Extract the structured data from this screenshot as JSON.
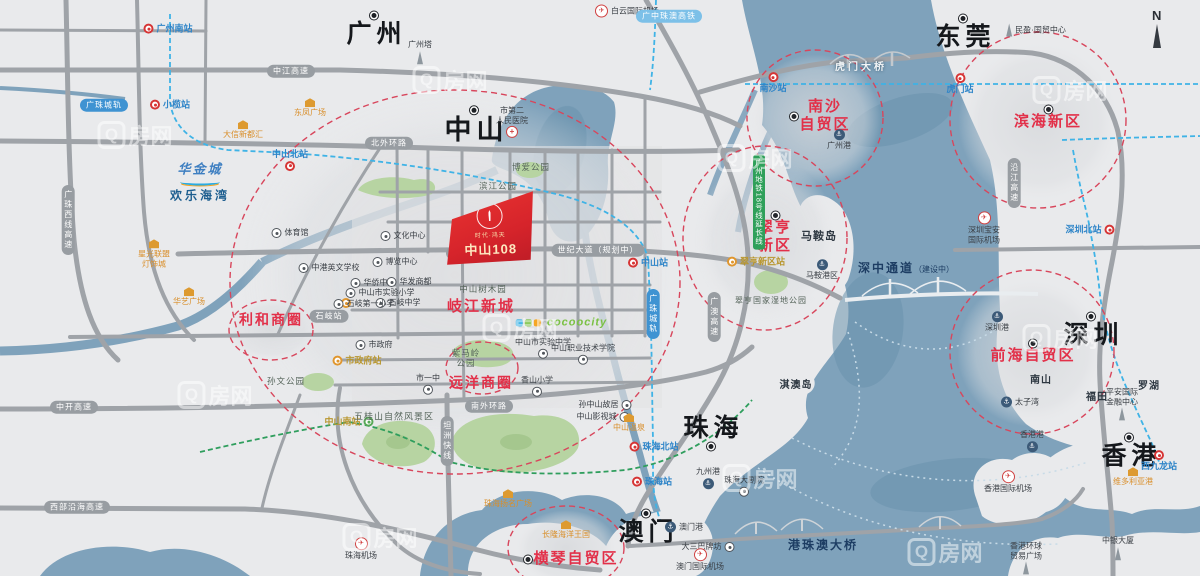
{
  "colors": {
    "water": "#7fa2bb",
    "land": "#e9eaec",
    "road": "#9fa3a8",
    "accent_red": "#e23049",
    "rail_blue": "#3fb3e6",
    "park_green": "#b7d4a2",
    "zone_red": "#d8465c"
  },
  "compass": {
    "label": "N"
  },
  "watermark": {
    "q": "Q",
    "text": "房网",
    "positions": [
      [
        135,
        135
      ],
      [
        450,
        80
      ],
      [
        755,
        158
      ],
      [
        1070,
        90
      ],
      [
        215,
        395
      ],
      [
        520,
        328
      ],
      [
        1060,
        338
      ],
      [
        760,
        478
      ],
      [
        380,
        537
      ],
      [
        945,
        552
      ]
    ]
  },
  "project": {
    "badge_line1": "时代·鸿天",
    "name": "中山108"
  },
  "logo": {
    "line1": "华金城",
    "line2": "欢乐海湾"
  },
  "labels": [
    {
      "n": "city-guangzhou",
      "c": "city",
      "t": "广州",
      "x": 374,
      "y": 31
    },
    {
      "n": "city-dongguan",
      "c": "city",
      "t": "东莞",
      "x": 963,
      "y": 34
    },
    {
      "n": "city-zhongshan",
      "c": "city",
      "t": "中山",
      "x": 474,
      "y": 127,
      "big": 1
    },
    {
      "n": "city-shenzhen",
      "c": "city",
      "t": "深圳",
      "x": 1091,
      "y": 332
    },
    {
      "n": "city-zhuhai",
      "c": "city",
      "t": "珠海",
      "x": 711,
      "y": 431,
      "dot": "b"
    },
    {
      "n": "city-macau",
      "c": "city",
      "t": "澳门",
      "x": 646,
      "y": 529
    },
    {
      "n": "city-hongkong",
      "c": "city",
      "t": "香港",
      "x": 1129,
      "y": 453
    },
    {
      "n": "zone-nansha",
      "c": "zone",
      "t": "南沙\n自贸区",
      "x": 821,
      "y": 116,
      "dot": "l"
    },
    {
      "n": "zone-binhai",
      "c": "zone",
      "t": "滨海新区",
      "x": 1048,
      "y": 119,
      "dot": "t"
    },
    {
      "n": "zone-cuiheng",
      "c": "zone",
      "t": "翠亨\n新区",
      "x": 775,
      "y": 234,
      "dot": "t"
    },
    {
      "n": "zone-qianhai",
      "c": "zone",
      "t": "前海自贸区",
      "x": 1033,
      "y": 353,
      "dot": "t"
    },
    {
      "n": "zone-lihe",
      "c": "zone",
      "t": "利和商圈",
      "x": 271,
      "y": 320,
      "sz": 14
    },
    {
      "n": "zone-yuanyang",
      "c": "zone",
      "t": "远洋商圈",
      "x": 481,
      "y": 383,
      "sz": 14
    },
    {
      "n": "zone-qijiang",
      "c": "zone",
      "t": "岐江新城",
      "x": 481,
      "y": 307
    },
    {
      "n": "zone-hengqin",
      "c": "zone",
      "t": "横琴自贸区",
      "x": 572,
      "y": 559,
      "dot": "l"
    },
    {
      "n": "station-guangzhounan",
      "c": "stm",
      "t": "广州南站",
      "x": 168,
      "y": 29,
      "s": "r"
    },
    {
      "n": "station-xiaolan",
      "c": "stm",
      "t": "小榄站",
      "x": 170,
      "y": 105,
      "s": "r"
    },
    {
      "n": "station-zhongshanbei",
      "c": "stm",
      "t": "中山北站",
      "x": 290,
      "y": 160,
      "s": "t"
    },
    {
      "n": "station-zhongshan",
      "c": "stm",
      "t": "中山站",
      "x": 648,
      "y": 263,
      "s": "r"
    },
    {
      "n": "station-nansha",
      "c": "stm",
      "t": "南沙站",
      "x": 773,
      "y": 83,
      "s": "b"
    },
    {
      "n": "station-humen",
      "c": "stm",
      "t": "虎门站",
      "x": 960,
      "y": 84,
      "s": "b"
    },
    {
      "n": "station-shenzhenbei",
      "c": "stm",
      "t": "深圳北站",
      "x": 1090,
      "y": 230,
      "s": "l"
    },
    {
      "n": "station-zhuhaibei",
      "c": "stm",
      "t": "珠海北站",
      "x": 654,
      "y": 447,
      "s": "r"
    },
    {
      "n": "station-zhuhai",
      "c": "stm",
      "t": "珠海站",
      "x": 652,
      "y": 482,
      "s": "r"
    },
    {
      "n": "station-xijiulong",
      "c": "stm",
      "t": "西九龙站",
      "x": 1159,
      "y": 461,
      "s": "b"
    },
    {
      "n": "station-zhongshannan",
      "c": "stg",
      "t": "中山南站",
      "x": 349,
      "y": 422,
      "s": "l"
    },
    {
      "n": "station-shizhengfu",
      "c": "sto",
      "t": "市政府站",
      "x": 357,
      "y": 361,
      "s": "r"
    },
    {
      "n": "station-cuihengxinqu",
      "c": "sto",
      "t": "翠亨新区站",
      "x": 756,
      "y": 262,
      "s": "r"
    },
    {
      "n": "station-minor-1",
      "c": "sto",
      "t": "",
      "x": 346,
      "y": 303,
      "s": "r"
    },
    {
      "n": "station-minor-2",
      "c": "sto",
      "t": "",
      "x": 512,
      "y": 243,
      "s": "r"
    },
    {
      "n": "landmark-no2-hospital",
      "c": "lm",
      "t": "市第二\n人民医院",
      "x": 512,
      "y": 122,
      "i": "hosp",
      "s": "t"
    },
    {
      "n": "landmark-wenhua-center",
      "c": "lm",
      "t": "文化中心",
      "x": 403,
      "y": 236
    },
    {
      "n": "landmark-tiyuguan",
      "c": "lm",
      "t": "体育馆",
      "x": 290,
      "y": 233
    },
    {
      "n": "landmark-bolan-center",
      "c": "lm",
      "t": "博览中心",
      "x": 395,
      "y": 262
    },
    {
      "n": "landmark-zhonggang-school",
      "c": "lm",
      "t": "中港英文学校",
      "x": 329,
      "y": 268
    },
    {
      "n": "landmark-huaqiao-school",
      "c": "lm",
      "t": "华侨中学",
      "x": 373,
      "y": 283
    },
    {
      "n": "landmark-shiyan-primary",
      "c": "lm",
      "t": "中山市实验小学",
      "x": 380,
      "y": 293
    },
    {
      "n": "landmark-huafa-mall",
      "c": "lm",
      "t": "华发商都",
      "x": 409,
      "y": 282
    },
    {
      "n": "landmark-shiqi-school",
      "c": "lm",
      "t": "石岐中学",
      "x": 398,
      "y": 303
    },
    {
      "n": "landmark-shiqi-primary",
      "c": "lm",
      "t": "石岐第一小学",
      "x": 364,
      "y": 304
    },
    {
      "n": "landmark-city-hall",
      "c": "lm",
      "t": "市政府",
      "x": 374,
      "y": 345
    },
    {
      "n": "landmark-shiyizhong",
      "c": "lm",
      "t": "市一中",
      "x": 428,
      "y": 384,
      "s": "t"
    },
    {
      "n": "landmark-shiyan-middle",
      "c": "lm",
      "t": "中山市实验中学",
      "x": 543,
      "y": 348,
      "s": "t"
    },
    {
      "n": "landmark-polytechnic",
      "c": "lm",
      "t": "中山职业技术学院",
      "x": 583,
      "y": 354,
      "s": "t"
    },
    {
      "n": "landmark-xiangshan-primary",
      "c": "lm",
      "t": "香山小学",
      "x": 537,
      "y": 386,
      "s": "t"
    },
    {
      "n": "landmark-sun-yatsen-residence",
      "c": "lm",
      "t": "孙中山故居",
      "x": 605,
      "y": 405,
      "s": "l"
    },
    {
      "n": "landmark-film-city",
      "c": "lm",
      "t": "中山影视城",
      "x": 603,
      "y": 417,
      "s": "l"
    },
    {
      "n": "landmark-zhuhai-opera",
      "c": "lm",
      "t": "珠海大剧院",
      "x": 744,
      "y": 486,
      "s": "t"
    },
    {
      "n": "landmark-dasanba",
      "c": "lm",
      "t": "大三巴牌坊",
      "x": 708,
      "y": 547,
      "s": "l"
    },
    {
      "n": "landmark-minying-itc",
      "c": "lm",
      "t": "民盈·国贸中心",
      "x": 1036,
      "y": 30,
      "i": "tower"
    },
    {
      "n": "landmark-pingan-ifc",
      "c": "lm",
      "t": "平安国际\n金融中心",
      "x": 1122,
      "y": 404,
      "i": "tower",
      "s": "t"
    },
    {
      "n": "landmark-boc-tower",
      "c": "lm",
      "t": "中银大厦",
      "x": 1118,
      "y": 548,
      "i": "tower",
      "s": "t"
    },
    {
      "n": "landmark-icc",
      "c": "lm",
      "t": "香港环球\n贸易广场",
      "x": 1026,
      "y": 558,
      "i": "tower",
      "s": "t"
    },
    {
      "n": "landmark-canton-tower",
      "c": "lm",
      "t": "广州塔",
      "x": 420,
      "y": 52,
      "i": "tower",
      "s": "t"
    },
    {
      "n": "area-maan-island",
      "c": "area",
      "t": "马鞍岛",
      "x": 819,
      "y": 237,
      "sz": 11
    },
    {
      "n": "area-qiao-island",
      "c": "area",
      "t": "淇澳岛",
      "x": 796,
      "y": 386
    },
    {
      "n": "area-nanshan",
      "c": "area",
      "t": "南山",
      "x": 1041,
      "y": 381
    },
    {
      "n": "area-futian",
      "c": "area",
      "t": "福田",
      "x": 1097,
      "y": 398
    },
    {
      "n": "area-luohu",
      "c": "area",
      "t": "罗湖",
      "x": 1149,
      "y": 387
    },
    {
      "n": "port-guangzhou",
      "c": "port",
      "t": "广州港",
      "x": 839,
      "y": 140,
      "s": "b"
    },
    {
      "n": "port-maan",
      "c": "port",
      "t": "马鞍港区",
      "x": 822,
      "y": 270,
      "s": "b"
    },
    {
      "n": "port-shenzhen",
      "c": "port",
      "t": "深圳港",
      "x": 997,
      "y": 322,
      "s": "b"
    },
    {
      "n": "port-taiziwan",
      "c": "port",
      "t": "太子湾",
      "x": 1020,
      "y": 402,
      "s": "r"
    },
    {
      "n": "port-hongkong",
      "c": "port",
      "t": "香港港",
      "x": 1032,
      "y": 441,
      "s": "t"
    },
    {
      "n": "port-jiuzhou",
      "c": "port",
      "t": "九州港",
      "x": 708,
      "y": 478,
      "s": "t"
    },
    {
      "n": "port-macau",
      "c": "port",
      "t": "澳门港",
      "x": 684,
      "y": 527,
      "s": "r"
    },
    {
      "n": "airport-baiyun",
      "c": "air",
      "t": "白云国际机场",
      "x": 627,
      "y": 11,
      "s": "r"
    },
    {
      "n": "airport-baoan",
      "c": "air",
      "t": "深圳宝安\n国际机场",
      "x": 984,
      "y": 228,
      "s": "b"
    },
    {
      "n": "airport-zhuhai",
      "c": "air",
      "t": "珠海机场",
      "x": 361,
      "y": 549,
      "s": "b"
    },
    {
      "n": "airport-macau",
      "c": "air",
      "t": "澳门国际机场",
      "x": 700,
      "y": 560,
      "s": "b"
    },
    {
      "n": "airport-hongkong",
      "c": "air",
      "t": "香港国际机场",
      "x": 1008,
      "y": 482,
      "s": "b"
    },
    {
      "n": "landmark-daxin-mall",
      "c": "gold",
      "t": "大信新都汇",
      "x": 243,
      "y": 130
    },
    {
      "n": "landmark-dongfeng-plaza",
      "c": "gold",
      "t": "东凤广场",
      "x": 310,
      "y": 108
    },
    {
      "n": "landmark-xingguang-union",
      "c": "gold",
      "t": "星光联盟\n灯饰城",
      "x": 154,
      "y": 254
    },
    {
      "n": "landmark-huayi-plaza",
      "c": "gold",
      "t": "华艺广场",
      "x": 189,
      "y": 297
    },
    {
      "n": "landmark-yangming-plaza",
      "c": "gold",
      "t": "珠海扬名广场",
      "x": 508,
      "y": 499
    },
    {
      "n": "landmark-changlong",
      "c": "gold",
      "t": "长隆海洋王国",
      "x": 566,
      "y": 530
    },
    {
      "n": "landmark-zhongshan-hotspring",
      "c": "gold",
      "t": "中山温泉",
      "x": 629,
      "y": 423
    },
    {
      "n": "landmark-victoria-harbour",
      "c": "gold",
      "t": "维多利亚港",
      "x": 1133,
      "y": 477
    },
    {
      "n": "brand-cocoocity",
      "c": "coco",
      "t": "cocoocity",
      "x": 566,
      "y": 323
    },
    {
      "n": "road-zhongjiang-expwy",
      "c": "rb",
      "t": "中江高速",
      "x": 291,
      "y": 71
    },
    {
      "n": "road-beiwaihuan",
      "c": "rb",
      "t": "北外环路",
      "x": 389,
      "y": 143
    },
    {
      "n": "road-qijiang-xilu",
      "c": "rb",
      "t": "岐江西路",
      "x": 470,
      "y": 253
    },
    {
      "n": "road-shiji-avenue",
      "c": "rb",
      "t": "世纪大道（规划中）",
      "x": 598,
      "y": 250
    },
    {
      "n": "road-nanwaihuan",
      "c": "rb",
      "t": "南外环路",
      "x": 489,
      "y": 406
    },
    {
      "n": "road-zhongkai-expwy",
      "c": "rb",
      "t": "中开高速",
      "x": 74,
      "y": 407
    },
    {
      "n": "road-xibu-yanhai-expwy",
      "c": "rb",
      "t": "西部沿海高速",
      "x": 77,
      "y": 507
    },
    {
      "n": "road-tanzhou-expwy",
      "c": "rb",
      "t": "坦洲快线",
      "x": 447,
      "y": 441,
      "v": 1
    },
    {
      "n": "road-guangzhu-xixian",
      "c": "rb",
      "t": "广珠西线高速",
      "x": 68,
      "y": 220,
      "v": 1
    },
    {
      "n": "road-yanjiang-expwy",
      "c": "rb",
      "t": "沿江高速",
      "x": 1014,
      "y": 183,
      "v": 1
    },
    {
      "n": "road-guangao-expwy",
      "c": "rb",
      "t": "广澳高速",
      "x": 714,
      "y": 317,
      "v": 1
    },
    {
      "n": "road-shiqi-stop",
      "c": "rb",
      "t": "石岐站",
      "x": 329,
      "y": 316
    },
    {
      "n": "rail-guangzhu-1",
      "c": "railb",
      "t": "广珠城轨",
      "x": 104,
      "y": 105
    },
    {
      "n": "rail-guangzhu-2",
      "c": "railb",
      "t": "广珠城轨",
      "x": 653,
      "y": 314,
      "v": 1
    },
    {
      "n": "rail-gz-zhuao-hsr",
      "c": "railb",
      "t": "广中珠澳高铁",
      "x": 669,
      "y": 16,
      "lt": 1
    },
    {
      "n": "rail-metro-line18",
      "c": "strip",
      "t": "广州地铁18号线延长线",
      "x": 759,
      "y": 202
    },
    {
      "n": "bridge-humen",
      "c": "bridge",
      "t": "虎门大桥",
      "x": 861,
      "y": 68,
      "st": "w"
    },
    {
      "n": "bridge-shenzhong",
      "c": "bridge",
      "t": "深中通道",
      "suffix": "（建设中）",
      "x": 906,
      "y": 268,
      "st": "n"
    },
    {
      "n": "bridge-hzmb",
      "c": "bridge",
      "t": "港珠澳大桥",
      "x": 823,
      "y": 545,
      "st": "n"
    },
    {
      "n": "park-wuguishan",
      "c": "park",
      "t": "五桂山自然风景区",
      "x": 394,
      "y": 417,
      "sz": 9
    },
    {
      "n": "park-cuiheng-wetland",
      "c": "park",
      "t": "翠亨国家湿地公园",
      "x": 771,
      "y": 301,
      "sz": 8
    },
    {
      "n": "park-sunwen",
      "c": "park",
      "t": "孙文公园",
      "x": 286,
      "y": 381
    },
    {
      "n": "park-binjiang",
      "c": "park",
      "t": "滨江公园",
      "x": 498,
      "y": 186
    },
    {
      "n": "park-boai",
      "c": "park",
      "t": "博爱公园",
      "x": 531,
      "y": 167
    },
    {
      "n": "park-shumuyuan",
      "c": "park",
      "t": "中山树木园",
      "x": 483,
      "y": 289
    },
    {
      "n": "park-zimaling",
      "c": "park",
      "t": "紫马岭\n公园",
      "x": 466,
      "y": 358
    }
  ]
}
